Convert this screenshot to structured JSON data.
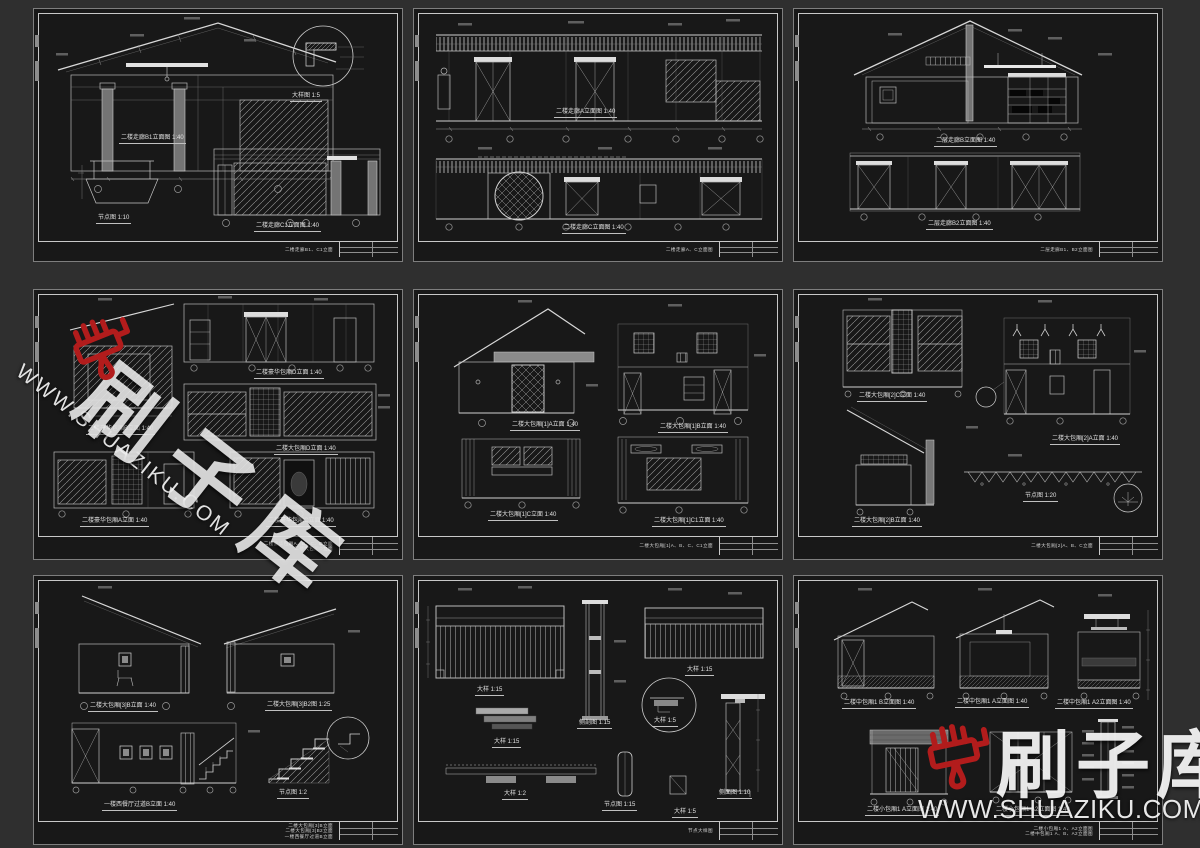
{
  "canvas": {
    "width": 1200,
    "height": 848,
    "background": "#2f2f2f"
  },
  "colors": {
    "sheet_background": "#181818",
    "frame_line": "#c8c8c8",
    "drawing_line": "#b9b9b9",
    "watermark_red": "#b21c1c",
    "watermark_white": "rgba(255,255,255,0.88)"
  },
  "watermark": {
    "brand_text": "刷子库",
    "url_text_diagonal": "WWW.SHUAZIKU.COM",
    "url_text_horizontal": "WWW.SHUAZIKU.COM",
    "brush_icon": "paint-brush-with-drip"
  },
  "sheets": [
    {
      "id": "sheet-1",
      "captions": [
        "二楼走廊B1立面图 1:40",
        "大样图 1:5",
        "节点图 1:10",
        "二楼走廊C1立面图 1:40"
      ],
      "title_block": [
        "二楼走廊B1、C1立面"
      ]
    },
    {
      "id": "sheet-2",
      "captions": [
        "二楼走廊A立面图 1:40",
        "二楼走廊C立面图 1:40"
      ],
      "title_block": [
        "二楼走廊A、C立面图"
      ]
    },
    {
      "id": "sheet-3",
      "captions": [
        "二层走廊B立面图 1:40",
        "二层走廊B2立面图 1:40"
      ],
      "title_block": [
        "二层走廊B1、B2立面图"
      ]
    },
    {
      "id": "sheet-4",
      "captions": [
        "二楼豪华包厢B立面 1:40",
        "二楼豪华包厢D立面 1:40",
        "二楼大包厢D立面 1:40",
        "二楼豪华包厢A立面 1:40",
        "二楼豪华包厢C立面 1:40"
      ],
      "title_block": [
        "二楼豪华包厢A、B、C、D立面",
        "二楼大包厢D立面"
      ]
    },
    {
      "id": "sheet-5",
      "captions": [
        "二楼大包厢[1]A立面 1:40",
        "二楼大包厢[1]B立面 1:40",
        "二楼大包厢[1]C立面 1:40",
        "二楼大包厢[1]C1立面 1:40"
      ],
      "title_block": [
        "二楼大包厢[1]A、B、C、C1立面"
      ]
    },
    {
      "id": "sheet-6",
      "captions": [
        "二楼大包厢[2]C立面 1:40",
        "二楼大包厢[2]A立面 1:40",
        "二楼大包厢[2]B立面 1:40",
        "节点图 1:20"
      ],
      "title_block": [
        "二楼大包厢[2]A、B、C立面"
      ]
    },
    {
      "id": "sheet-7",
      "captions": [
        "二楼大包厢[3]B立面 1:40",
        "二楼大包厢[3]B2图 1:25",
        "一楼西餐厅过道B立面 1:40",
        "节点图 1:2"
      ],
      "title_block": [
        "二楼大包厢[3]B立面",
        "二楼大包厢[3]B2立面",
        "一楼西餐厅过道B立面"
      ]
    },
    {
      "id": "sheet-8",
      "captions": [
        "大样 1:15",
        "侧剖图 1:15",
        "大样 1:15",
        "大样 1:5",
        "大样 1:15",
        "大样 1:2",
        "节点图 1:15",
        "大样 1:5",
        "侧面图 1:10"
      ],
      "title_block": [
        "节点大样图"
      ]
    },
    {
      "id": "sheet-9",
      "captions": [
        "二楼中包厢1 B立面图 1:40",
        "二楼中包厢1 A立面图 1:40",
        "二楼中包厢1 A2立面图 1:40",
        "二楼小包厢1 A立面图 1:40",
        "二楼小包厢1 A2立面图 1:40"
      ],
      "title_block": [
        "二楼小包厢1 A、A2立面图",
        "二楼中包厢1 A、B、A2立面图"
      ]
    }
  ]
}
